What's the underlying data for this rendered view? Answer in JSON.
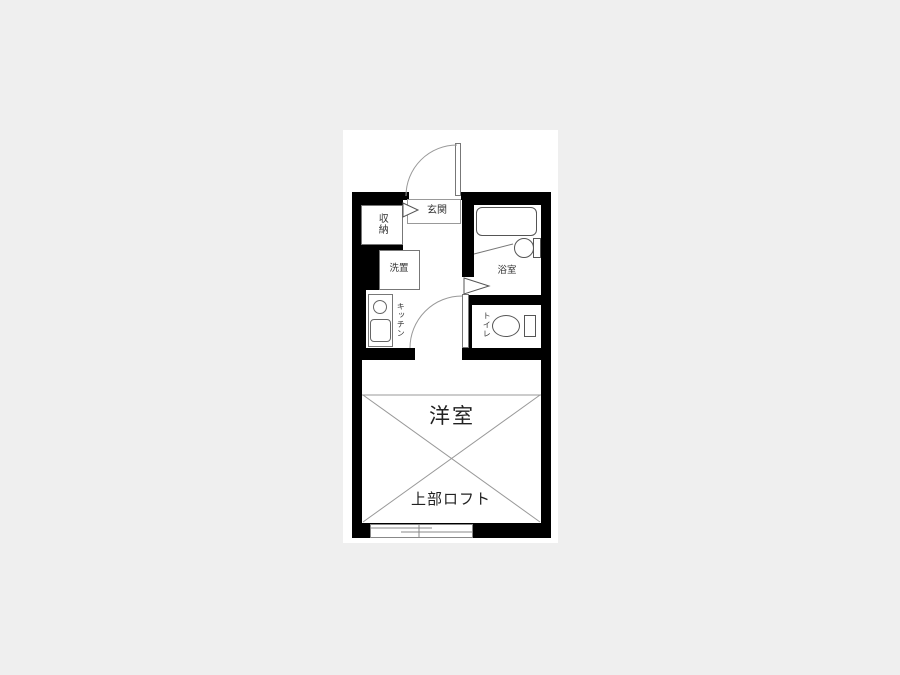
{
  "floorplan": {
    "colors": {
      "page_background": "#efefef",
      "card_background": "#ffffff",
      "wall": "#000000",
      "line": "#999999",
      "text": "#333333"
    },
    "rooms": {
      "entrance": {
        "label": "玄関"
      },
      "storage": {
        "label": "収納"
      },
      "laundry": {
        "label": "洗置"
      },
      "kitchen": {
        "label": "キッチン"
      },
      "bathroom": {
        "label": "浴室"
      },
      "toilet": {
        "label": "トイレ"
      },
      "western_room": {
        "label": "洋室"
      },
      "loft": {
        "label": "上部ロフト"
      }
    }
  }
}
